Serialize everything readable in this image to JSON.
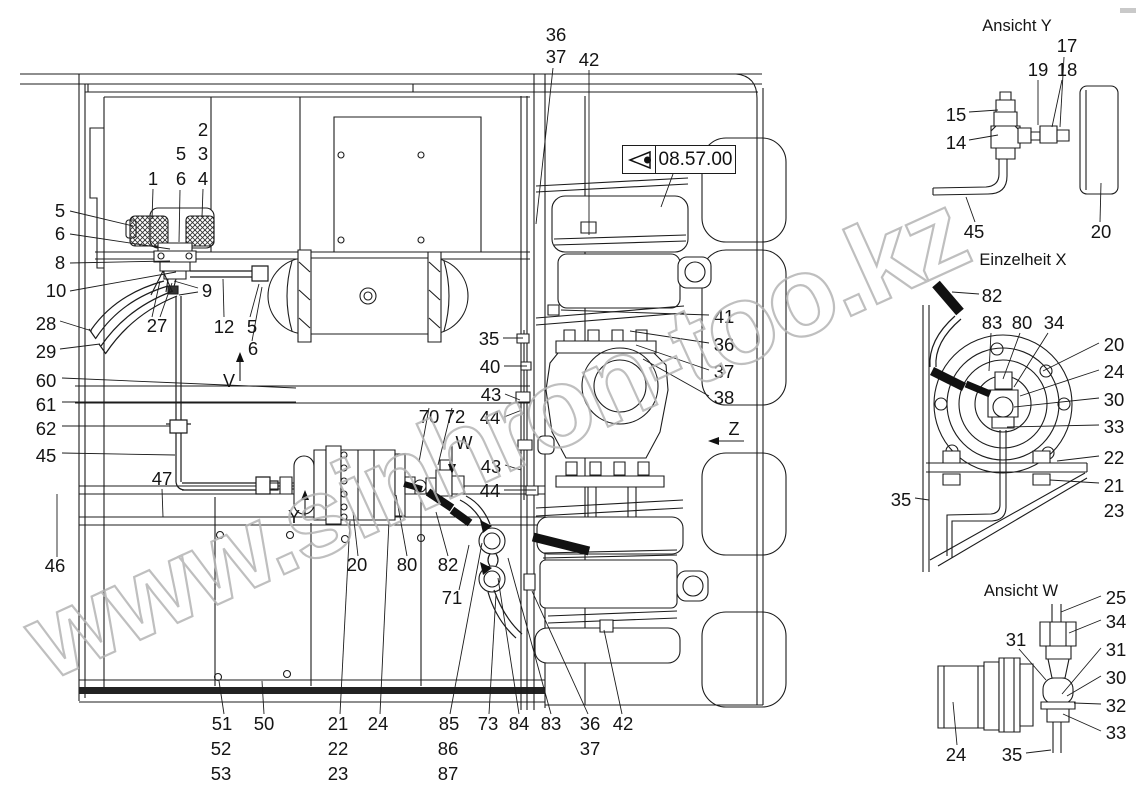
{
  "page": {
    "background": "#ffffff",
    "line_color": "#1c1c1c",
    "watermark_color": "#b4b4b4"
  },
  "watermark": {
    "text": "www.sinhron-too.kz"
  },
  "badge": {
    "code": "08.57.00",
    "icon": "view-direction-eye-icon"
  },
  "view_titles": [
    {
      "t": "Ansicht Y",
      "x": 1017,
      "y": 26
    },
    {
      "t": "Einzelheit X",
      "x": 1023,
      "y": 260
    },
    {
      "t": "Ansicht W",
      "x": 1021,
      "y": 591
    }
  ],
  "direction_markers": [
    {
      "t": "V",
      "x": 229,
      "y": 381
    },
    {
      "t": "W",
      "x": 464,
      "y": 443
    },
    {
      "t": "Y",
      "x": 294,
      "y": 517
    },
    {
      "t": "Z",
      "x": 734,
      "y": 429
    }
  ],
  "callouts": [
    {
      "t": "5",
      "x": 60,
      "y": 211
    },
    {
      "t": "6",
      "x": 60,
      "y": 234
    },
    {
      "t": "8",
      "x": 60,
      "y": 263
    },
    {
      "t": "10",
      "x": 56,
      "y": 291
    },
    {
      "t": "28",
      "x": 46,
      "y": 324
    },
    {
      "t": "29",
      "x": 46,
      "y": 352
    },
    {
      "t": "60",
      "x": 46,
      "y": 381
    },
    {
      "t": "61",
      "x": 46,
      "y": 405
    },
    {
      "t": "62",
      "x": 46,
      "y": 429
    },
    {
      "t": "45",
      "x": 46,
      "y": 456
    },
    {
      "t": "47",
      "x": 162,
      "y": 479
    },
    {
      "t": "46",
      "x": 55,
      "y": 566
    },
    {
      "t": "1",
      "x": 153,
      "y": 179
    },
    {
      "t": "5",
      "x": 181,
      "y": 154
    },
    {
      "t": "6",
      "x": 181,
      "y": 179
    },
    {
      "t": "2",
      "x": 203,
      "y": 130
    },
    {
      "t": "3",
      "x": 203,
      "y": 154
    },
    {
      "t": "4",
      "x": 203,
      "y": 179
    },
    {
      "t": "27",
      "x": 157,
      "y": 326
    },
    {
      "t": "9",
      "x": 207,
      "y": 291
    },
    {
      "t": "12",
      "x": 224,
      "y": 327
    },
    {
      "t": "5",
      "x": 252,
      "y": 327
    },
    {
      "t": "6",
      "x": 253,
      "y": 349
    },
    {
      "t": "35",
      "x": 489,
      "y": 339
    },
    {
      "t": "40",
      "x": 490,
      "y": 367
    },
    {
      "t": "43",
      "x": 491,
      "y": 395
    },
    {
      "t": "44",
      "x": 490,
      "y": 418
    },
    {
      "t": "70",
      "x": 429,
      "y": 417
    },
    {
      "t": "72",
      "x": 455,
      "y": 417
    },
    {
      "t": "43",
      "x": 491,
      "y": 467
    },
    {
      "t": "44",
      "x": 490,
      "y": 491
    },
    {
      "t": "41",
      "x": 724,
      "y": 317
    },
    {
      "t": "36",
      "x": 724,
      "y": 345
    },
    {
      "t": "37",
      "x": 724,
      "y": 372
    },
    {
      "t": "38",
      "x": 724,
      "y": 398
    },
    {
      "t": "36",
      "x": 556,
      "y": 35
    },
    {
      "t": "37",
      "x": 556,
      "y": 57
    },
    {
      "t": "42",
      "x": 589,
      "y": 60
    },
    {
      "t": "20",
      "x": 357,
      "y": 565
    },
    {
      "t": "80",
      "x": 407,
      "y": 565
    },
    {
      "t": "82",
      "x": 448,
      "y": 565
    },
    {
      "t": "71",
      "x": 452,
      "y": 598
    },
    {
      "t": "51",
      "x": 222,
      "y": 724
    },
    {
      "t": "52",
      "x": 221,
      "y": 749
    },
    {
      "t": "53",
      "x": 221,
      "y": 774
    },
    {
      "t": "50",
      "x": 264,
      "y": 724
    },
    {
      "t": "21",
      "x": 338,
      "y": 724
    },
    {
      "t": "22",
      "x": 338,
      "y": 749
    },
    {
      "t": "23",
      "x": 338,
      "y": 774
    },
    {
      "t": "24",
      "x": 378,
      "y": 724
    },
    {
      "t": "85",
      "x": 449,
      "y": 724
    },
    {
      "t": "86",
      "x": 448,
      "y": 749
    },
    {
      "t": "87",
      "x": 448,
      "y": 774
    },
    {
      "t": "73",
      "x": 488,
      "y": 724
    },
    {
      "t": "84",
      "x": 519,
      "y": 724
    },
    {
      "t": "83",
      "x": 551,
      "y": 724
    },
    {
      "t": "36",
      "x": 590,
      "y": 724
    },
    {
      "t": "37",
      "x": 590,
      "y": 749
    },
    {
      "t": "42",
      "x": 623,
      "y": 724
    },
    {
      "t": "17",
      "x": 1067,
      "y": 46
    },
    {
      "t": "19",
      "x": 1038,
      "y": 70
    },
    {
      "t": "18",
      "x": 1067,
      "y": 70
    },
    {
      "t": "15",
      "x": 956,
      "y": 115
    },
    {
      "t": "14",
      "x": 956,
      "y": 143
    },
    {
      "t": "45",
      "x": 974,
      "y": 232
    },
    {
      "t": "20",
      "x": 1101,
      "y": 232
    },
    {
      "t": "82",
      "x": 992,
      "y": 296
    },
    {
      "t": "83",
      "x": 992,
      "y": 323
    },
    {
      "t": "80",
      "x": 1022,
      "y": 323
    },
    {
      "t": "34",
      "x": 1054,
      "y": 323
    },
    {
      "t": "20",
      "x": 1114,
      "y": 345
    },
    {
      "t": "24",
      "x": 1114,
      "y": 372
    },
    {
      "t": "30",
      "x": 1114,
      "y": 400
    },
    {
      "t": "33",
      "x": 1114,
      "y": 427
    },
    {
      "t": "22",
      "x": 1114,
      "y": 458
    },
    {
      "t": "21",
      "x": 1114,
      "y": 486
    },
    {
      "t": "23",
      "x": 1114,
      "y": 511
    },
    {
      "t": "35",
      "x": 901,
      "y": 500
    },
    {
      "t": "25",
      "x": 1116,
      "y": 598
    },
    {
      "t": "34",
      "x": 1116,
      "y": 622
    },
    {
      "t": "31",
      "x": 1016,
      "y": 640
    },
    {
      "t": "31",
      "x": 1116,
      "y": 650
    },
    {
      "t": "30",
      "x": 1116,
      "y": 678
    },
    {
      "t": "32",
      "x": 1116,
      "y": 706
    },
    {
      "t": "33",
      "x": 1116,
      "y": 733
    },
    {
      "t": "24",
      "x": 956,
      "y": 755
    },
    {
      "t": "35",
      "x": 1012,
      "y": 755
    }
  ]
}
